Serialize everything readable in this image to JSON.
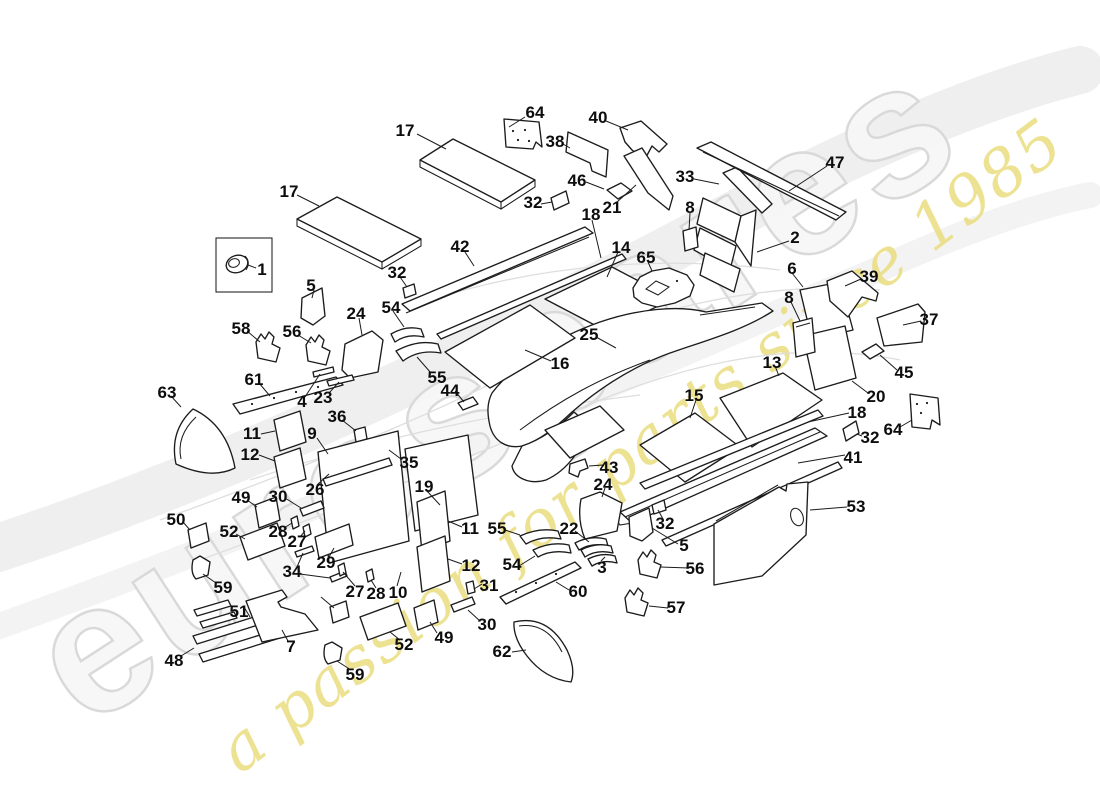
{
  "watermark": {
    "brand_text": "eurospares",
    "tagline_text": "a passion for parts since 1985",
    "brand_color": "#d8d8d8",
    "tagline_color": "#e9dd7f"
  },
  "diagram": {
    "line_color": "#1c1c1c",
    "background_color": "#ffffff"
  },
  "callouts": [
    {
      "label": "64",
      "x": 535,
      "y": 112
    },
    {
      "label": "40",
      "x": 598,
      "y": 117
    },
    {
      "label": "17",
      "x": 405,
      "y": 130
    },
    {
      "label": "38",
      "x": 555,
      "y": 141
    },
    {
      "label": "47",
      "x": 835,
      "y": 162
    },
    {
      "label": "33",
      "x": 685,
      "y": 176
    },
    {
      "label": "46",
      "x": 577,
      "y": 180
    },
    {
      "label": "17",
      "x": 289,
      "y": 191
    },
    {
      "label": "32",
      "x": 533,
      "y": 202
    },
    {
      "label": "21",
      "x": 612,
      "y": 207
    },
    {
      "label": "8",
      "x": 690,
      "y": 207
    },
    {
      "label": "18",
      "x": 591,
      "y": 214
    },
    {
      "label": "2",
      "x": 795,
      "y": 237
    },
    {
      "label": "42",
      "x": 460,
      "y": 246
    },
    {
      "label": "14",
      "x": 621,
      "y": 247
    },
    {
      "label": "65",
      "x": 646,
      "y": 257
    },
    {
      "label": "6",
      "x": 792,
      "y": 268
    },
    {
      "label": "1",
      "x": 262,
      "y": 269
    },
    {
      "label": "32",
      "x": 397,
      "y": 272
    },
    {
      "label": "39",
      "x": 869,
      "y": 276
    },
    {
      "label": "5",
      "x": 311,
      "y": 285
    },
    {
      "label": "8",
      "x": 789,
      "y": 297
    },
    {
      "label": "54",
      "x": 391,
      "y": 307
    },
    {
      "label": "24",
      "x": 356,
      "y": 313
    },
    {
      "label": "37",
      "x": 929,
      "y": 319
    },
    {
      "label": "58",
      "x": 241,
      "y": 328
    },
    {
      "label": "56",
      "x": 292,
      "y": 331
    },
    {
      "label": "25",
      "x": 589,
      "y": 334
    },
    {
      "label": "16",
      "x": 560,
      "y": 363
    },
    {
      "label": "13",
      "x": 772,
      "y": 362
    },
    {
      "label": "45",
      "x": 904,
      "y": 372
    },
    {
      "label": "55",
      "x": 437,
      "y": 377
    },
    {
      "label": "61",
      "x": 254,
      "y": 379
    },
    {
      "label": "44",
      "x": 450,
      "y": 390
    },
    {
      "label": "63",
      "x": 167,
      "y": 392
    },
    {
      "label": "15",
      "x": 694,
      "y": 395
    },
    {
      "label": "20",
      "x": 876,
      "y": 396
    },
    {
      "label": "23",
      "x": 323,
      "y": 397
    },
    {
      "label": "4",
      "x": 302,
      "y": 401
    },
    {
      "label": "18",
      "x": 857,
      "y": 412
    },
    {
      "label": "36",
      "x": 337,
      "y": 416
    },
    {
      "label": "64",
      "x": 893,
      "y": 429
    },
    {
      "label": "11",
      "x": 252,
      "y": 433
    },
    {
      "label": "9",
      "x": 312,
      "y": 433
    },
    {
      "label": "32",
      "x": 870,
      "y": 437
    },
    {
      "label": "12",
      "x": 250,
      "y": 454
    },
    {
      "label": "41",
      "x": 853,
      "y": 457
    },
    {
      "label": "35",
      "x": 409,
      "y": 462
    },
    {
      "label": "43",
      "x": 609,
      "y": 467
    },
    {
      "label": "24",
      "x": 603,
      "y": 484
    },
    {
      "label": "19",
      "x": 424,
      "y": 486
    },
    {
      "label": "26",
      "x": 315,
      "y": 489
    },
    {
      "label": "30",
      "x": 278,
      "y": 496
    },
    {
      "label": "49",
      "x": 241,
      "y": 497
    },
    {
      "label": "53",
      "x": 856,
      "y": 506
    },
    {
      "label": "50",
      "x": 176,
      "y": 519
    },
    {
      "label": "32",
      "x": 665,
      "y": 523
    },
    {
      "label": "11",
      "x": 470,
      "y": 528
    },
    {
      "label": "55",
      "x": 497,
      "y": 528
    },
    {
      "label": "22",
      "x": 569,
      "y": 528
    },
    {
      "label": "28",
      "x": 278,
      "y": 531
    },
    {
      "label": "52",
      "x": 229,
      "y": 531
    },
    {
      "label": "27",
      "x": 297,
      "y": 541
    },
    {
      "label": "5",
      "x": 684,
      "y": 545
    },
    {
      "label": "29",
      "x": 326,
      "y": 562
    },
    {
      "label": "54",
      "x": 512,
      "y": 564
    },
    {
      "label": "12",
      "x": 471,
      "y": 565
    },
    {
      "label": "3",
      "x": 602,
      "y": 567
    },
    {
      "label": "56",
      "x": 695,
      "y": 568
    },
    {
      "label": "34",
      "x": 292,
      "y": 571
    },
    {
      "label": "31",
      "x": 489,
      "y": 585
    },
    {
      "label": "59",
      "x": 223,
      "y": 587
    },
    {
      "label": "27",
      "x": 355,
      "y": 591
    },
    {
      "label": "60",
      "x": 578,
      "y": 591
    },
    {
      "label": "10",
      "x": 398,
      "y": 592
    },
    {
      "label": "28",
      "x": 376,
      "y": 593
    },
    {
      "label": "57",
      "x": 676,
      "y": 607
    },
    {
      "label": "51",
      "x": 239,
      "y": 611
    },
    {
      "label": "30",
      "x": 487,
      "y": 624
    },
    {
      "label": "49",
      "x": 444,
      "y": 637
    },
    {
      "label": "52",
      "x": 404,
      "y": 644
    },
    {
      "label": "7",
      "x": 291,
      "y": 646
    },
    {
      "label": "62",
      "x": 502,
      "y": 651
    },
    {
      "label": "48",
      "x": 174,
      "y": 660
    },
    {
      "label": "59",
      "x": 355,
      "y": 674
    }
  ]
}
